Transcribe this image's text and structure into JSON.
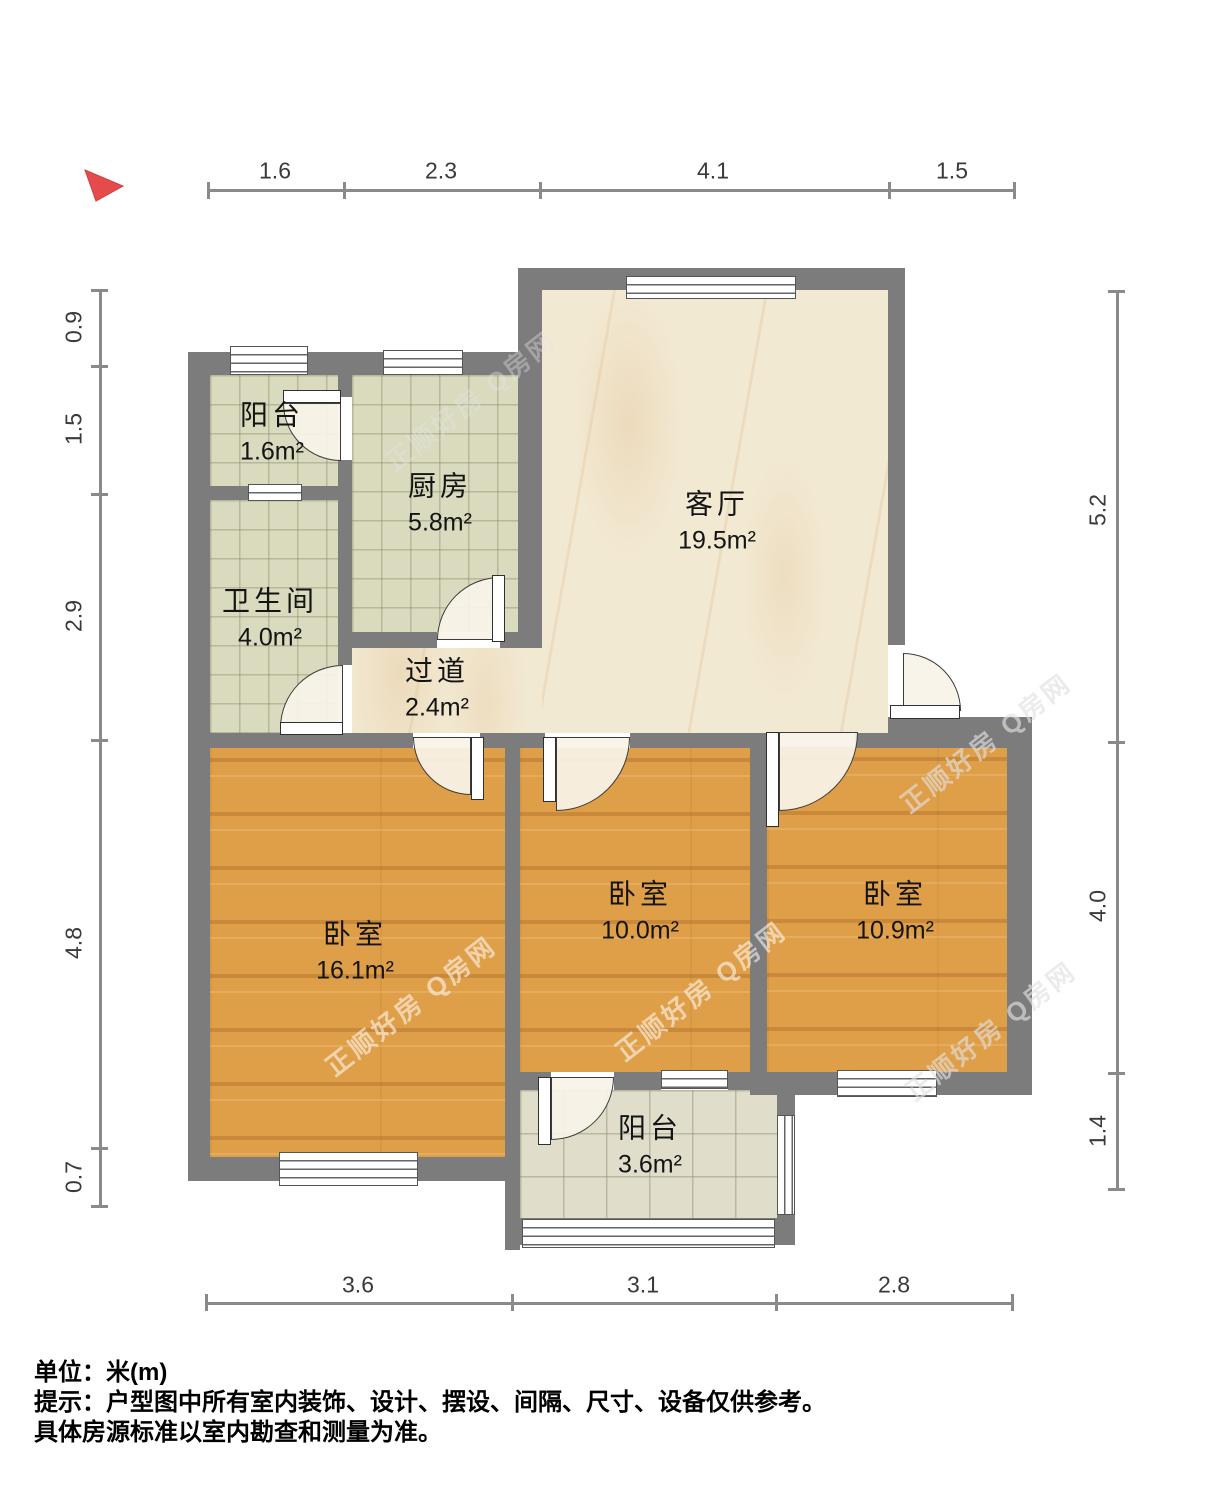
{
  "watermark": {
    "text": "正顺好房 Q房网"
  },
  "rooms": [
    {
      "name": "阳台",
      "area": "1.6m²"
    },
    {
      "name": "厨房",
      "area": "5.8m²"
    },
    {
      "name": "卫生间",
      "area": "4.0m²"
    },
    {
      "name": "过道",
      "area": "2.4m²"
    },
    {
      "name": "客厅",
      "area": "19.5m²"
    },
    {
      "name": "卧室",
      "area": "16.1m²"
    },
    {
      "name": "卧室",
      "area": "10.0m²"
    },
    {
      "name": "卧室",
      "area": "10.9m²"
    },
    {
      "name": "阳台",
      "area": "3.6m²"
    }
  ],
  "dimensions": {
    "top": [
      "1.6",
      "2.3",
      "4.1",
      "1.5"
    ],
    "left": [
      "0.9",
      "1.5",
      "2.9",
      "4.8",
      "0.7"
    ],
    "right": [
      "5.2",
      "4.0",
      "1.4"
    ],
    "bottom": [
      "3.6",
      "3.1",
      "2.8"
    ]
  },
  "notes": {
    "unit": "单位：米(m)",
    "hint1": "提示：户型图中所有室内装饰、设计、摆设、间隔、尺寸、设备仅供参考。",
    "hint2": "具体房源标准以室内勘查和测量为准。"
  },
  "colors": {
    "wall": "#7c7c7c",
    "wood_floor": "#df9f49",
    "tile_floor": "#d9dabe",
    "balcony_tile_floor": "#e0decb",
    "marble_floor": "#f2e9d2",
    "north_arrow": "#e64b4b",
    "dim_line": "#8a8a8a",
    "dim_text": "#3a3a3a"
  }
}
